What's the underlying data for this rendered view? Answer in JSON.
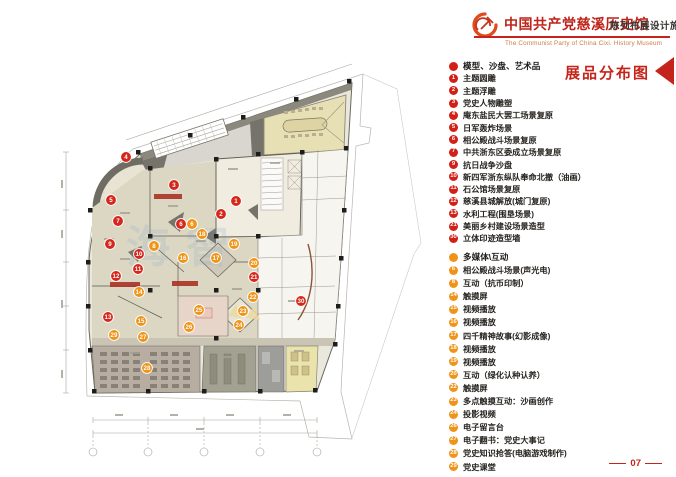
{
  "colors": {
    "accent": "#c5241b",
    "title": "#bf241a",
    "subtitle": "#3a3733",
    "english": "#d07a4a",
    "legend_red": "#d32017",
    "legend_orange": "#ef9418"
  },
  "header": {
    "emblem_icon": "party-emblem",
    "title_cn": "中国共产党慈溪历史馆",
    "title_en": "The Communist Party of China Cixi. History Museum",
    "subtitle_cn": "陈列布展设计施工方案"
  },
  "legend": {
    "title": "展品分布图",
    "sections": [
      {
        "id": "models",
        "header": "模型、沙盘、艺术品",
        "color": "#d32017",
        "items": [
          {
            "num": "1",
            "label": "主题圆雕"
          },
          {
            "num": "2",
            "label": "主题浮雕"
          },
          {
            "num": "3",
            "label": "党史人物雕塑"
          },
          {
            "num": "4",
            "label": "庵东盐民大罢工场景复原"
          },
          {
            "num": "5",
            "label": "日军轰炸场景"
          },
          {
            "num": "6",
            "label": "相公殿战斗场景复原"
          },
          {
            "num": "7",
            "label": "中共浙东区委成立场景复原"
          },
          {
            "num": "9",
            "label": "抗日战争沙盘"
          },
          {
            "num": "10",
            "label": "新四军浙东纵队奉命北撤（油画）"
          },
          {
            "num": "11",
            "label": "石公馆场景复原"
          },
          {
            "num": "12",
            "label": "慈溪县城解放(城门复原)"
          },
          {
            "num": "13",
            "label": "水利工程(围垦场景)"
          },
          {
            "num": "21",
            "label": "美丽乡村建设场景造型"
          },
          {
            "num": "30",
            "label": "立体印迹造型墙"
          }
        ]
      },
      {
        "id": "media",
        "header": "多媒体\\互动",
        "color": "#ef9418",
        "items": [
          {
            "num": "6",
            "label": "相公殿战斗场景(声光电)"
          },
          {
            "num": "8",
            "label": "互动（抗币印制）"
          },
          {
            "num": "14",
            "label": "触摸屏"
          },
          {
            "num": "15",
            "label": "视频播放"
          },
          {
            "num": "16",
            "label": "视频播放"
          },
          {
            "num": "17",
            "label": "四千精神故事(幻影成像)"
          },
          {
            "num": "18",
            "label": "视频播放"
          },
          {
            "num": "19",
            "label": "视频播放"
          },
          {
            "num": "20",
            "label": "互动（绿化认种认养）"
          },
          {
            "num": "22",
            "label": "触摸屏"
          },
          {
            "num": "23",
            "label": "多点触摸互动：沙画创作"
          },
          {
            "num": "24",
            "label": "投影视频"
          },
          {
            "num": "26",
            "label": "电子留言台"
          },
          {
            "num": "27",
            "label": "电子翻书：党史大事记"
          },
          {
            "num": "28",
            "label": "党史知识抢答(电脑游戏制作)"
          },
          {
            "num": "29",
            "label": "党史课堂"
          }
        ]
      }
    ]
  },
  "plan": {
    "marker_colors": {
      "model": "#d5281c",
      "media": "#ef9418"
    },
    "markers": [
      {
        "num": "1",
        "type": "model",
        "x": 236,
        "y": 201
      },
      {
        "num": "2",
        "type": "model",
        "x": 221,
        "y": 214
      },
      {
        "num": "3",
        "type": "model",
        "x": 174,
        "y": 185
      },
      {
        "num": "4",
        "type": "model",
        "x": 126,
        "y": 157
      },
      {
        "num": "5",
        "type": "model",
        "x": 111,
        "y": 200
      },
      {
        "num": "6",
        "type": "model",
        "x": 181,
        "y": 224
      },
      {
        "num": "7",
        "type": "model",
        "x": 118,
        "y": 221
      },
      {
        "num": "9",
        "type": "model",
        "x": 110,
        "y": 244
      },
      {
        "num": "10",
        "type": "model",
        "x": 139,
        "y": 254
      },
      {
        "num": "11",
        "type": "model",
        "x": 138,
        "y": 269
      },
      {
        "num": "12",
        "type": "model",
        "x": 116,
        "y": 276
      },
      {
        "num": "13",
        "type": "model",
        "x": 108,
        "y": 317
      },
      {
        "num": "21",
        "type": "model",
        "x": 254,
        "y": 277
      },
      {
        "num": "30",
        "type": "model",
        "x": 301,
        "y": 301
      },
      {
        "num": "6",
        "type": "media",
        "x": 192,
        "y": 224
      },
      {
        "num": "8",
        "type": "media",
        "x": 154,
        "y": 246
      },
      {
        "num": "14",
        "type": "media",
        "x": 139,
        "y": 292
      },
      {
        "num": "15",
        "type": "media",
        "x": 141,
        "y": 321
      },
      {
        "num": "16",
        "type": "media",
        "x": 183,
        "y": 258
      },
      {
        "num": "17",
        "type": "media",
        "x": 216,
        "y": 258
      },
      {
        "num": "18",
        "type": "media",
        "x": 202,
        "y": 234
      },
      {
        "num": "19",
        "type": "media",
        "x": 234,
        "y": 244
      },
      {
        "num": "20",
        "type": "media",
        "x": 254,
        "y": 263
      },
      {
        "num": "22",
        "type": "media",
        "x": 253,
        "y": 297
      },
      {
        "num": "23",
        "type": "media",
        "x": 243,
        "y": 311
      },
      {
        "num": "24",
        "type": "media",
        "x": 239,
        "y": 325
      },
      {
        "num": "25",
        "type": "media",
        "x": 199,
        "y": 310
      },
      {
        "num": "26",
        "type": "media",
        "x": 189,
        "y": 327
      },
      {
        "num": "27",
        "type": "media",
        "x": 143,
        "y": 337
      },
      {
        "num": "28",
        "type": "media",
        "x": 147,
        "y": 368
      },
      {
        "num": "29",
        "type": "media",
        "x": 114,
        "y": 335
      }
    ]
  },
  "watermark": "海智",
  "page_number": "07"
}
